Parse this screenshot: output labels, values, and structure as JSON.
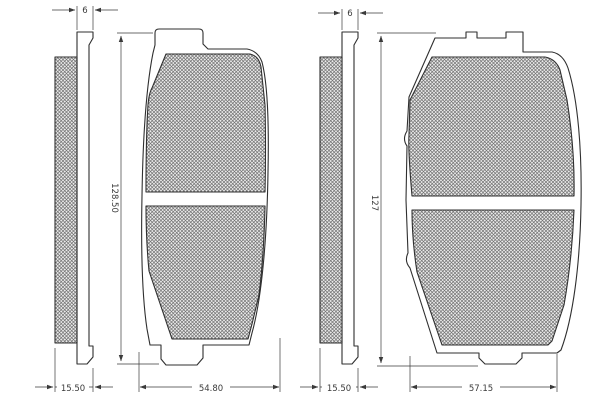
{
  "drawing": {
    "type": "technical-drawing",
    "subject": "Disc brake pad set - edge views and front views of two pad shapes with dimensions in mm",
    "colors": {
      "background": "#ffffff",
      "line": "#2f2f2f",
      "dimension_line": "#3a3a3a",
      "hatch_line": "#707070",
      "hatch_background": "#ececec",
      "text": "#3a3a3a"
    },
    "left_pad": {
      "labels": {
        "backplate_thickness": "6",
        "height": "128.50",
        "total_thickness": "15.50",
        "width": "54.80"
      }
    },
    "right_pad": {
      "labels": {
        "backplate_thickness": "6",
        "height": "127",
        "total_thickness": "15.50",
        "width": "57.15"
      }
    }
  }
}
